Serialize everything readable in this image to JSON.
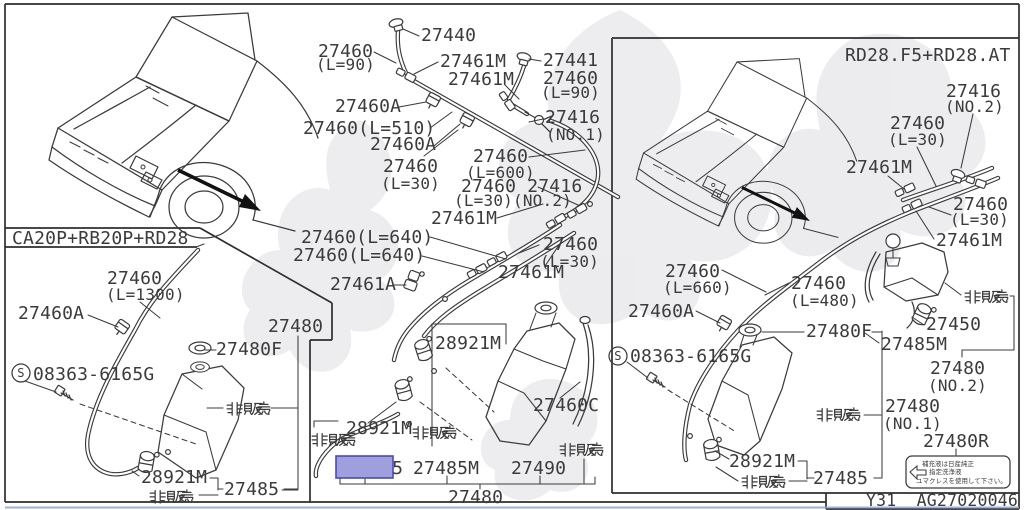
{
  "colors": {
    "highlight_fill": "#9f9fdd",
    "highlight_border": "#4a4ab8",
    "line": "#3b3b3b",
    "watermark": "#e1e1e6",
    "scan_edge": "#8fa3cf"
  },
  "strings": {
    "not_sold": "非販売",
    "circled_s": "S"
  },
  "left_panel": {
    "header": "CA20P+RB20P+RD28",
    "labels": {
      "a1": "27460",
      "a1b": "(L=1300)",
      "a2": "27460A",
      "a3": "08363-6165G",
      "a4": "27480",
      "a5": "27480F",
      "a6": "28921M",
      "a7": "27485"
    }
  },
  "center_panel": {
    "labels": {
      "c1": "27440",
      "c2": "27460",
      "c2b": "(L=90)",
      "c3": "27461M",
      "c4": "27441",
      "c5": "27461M",
      "c6": "27460",
      "c6b": "(L=90)",
      "c7": "27460A",
      "c8": "27460(L=510)",
      "c9": "27460A",
      "c10": "27416",
      "c10b": "(NO.1)",
      "c11": "27460",
      "c11b": "(L=30)",
      "c12": "27460",
      "c12b": "(L=600)",
      "c13": "27460 27416",
      "c13b": "(L=30)(NO.2)",
      "c14": "27461M",
      "c15": "27460(L=640)",
      "c16": "27460(L=640)",
      "c17": "27460",
      "c17b": "(L=30)",
      "c18": "27461M",
      "c19": "27461A",
      "c20": "28921M",
      "c21": "27460C",
      "c22": "28921M",
      "c23": "27485",
      "c24": "27485M",
      "c25": "27490",
      "c26": "27480"
    }
  },
  "right_panel": {
    "header": "RD28.F5+RD28.AT",
    "labels": {
      "r1": "27416",
      "r1b": "(NO.2)",
      "r2": "27460",
      "r2b": "(L=30)",
      "r3": "27461M",
      "r4": "27460",
      "r4b": "(L=30)",
      "r5": "27461M",
      "r6": "27460",
      "r6b": "(L=660)",
      "r7": "27460A",
      "r8": "27460",
      "r8b": "(L=480)",
      "r9": "08363-6165G",
      "r10": "27480F",
      "r11": "27450",
      "r12": "27485M",
      "r13": "27480",
      "r13b": "(NO.2)",
      "r14": "27480",
      "r14b": "(NO.1)",
      "r15": "27480R",
      "r16": "28921M",
      "r17": "27485"
    },
    "note_box": {
      "line1": "補充液は日産純正",
      "line2": "指定洗浄液",
      "line3": "ユマクレスを使用して下さい。"
    }
  },
  "footer": {
    "code": "Y31  AG27020046"
  }
}
